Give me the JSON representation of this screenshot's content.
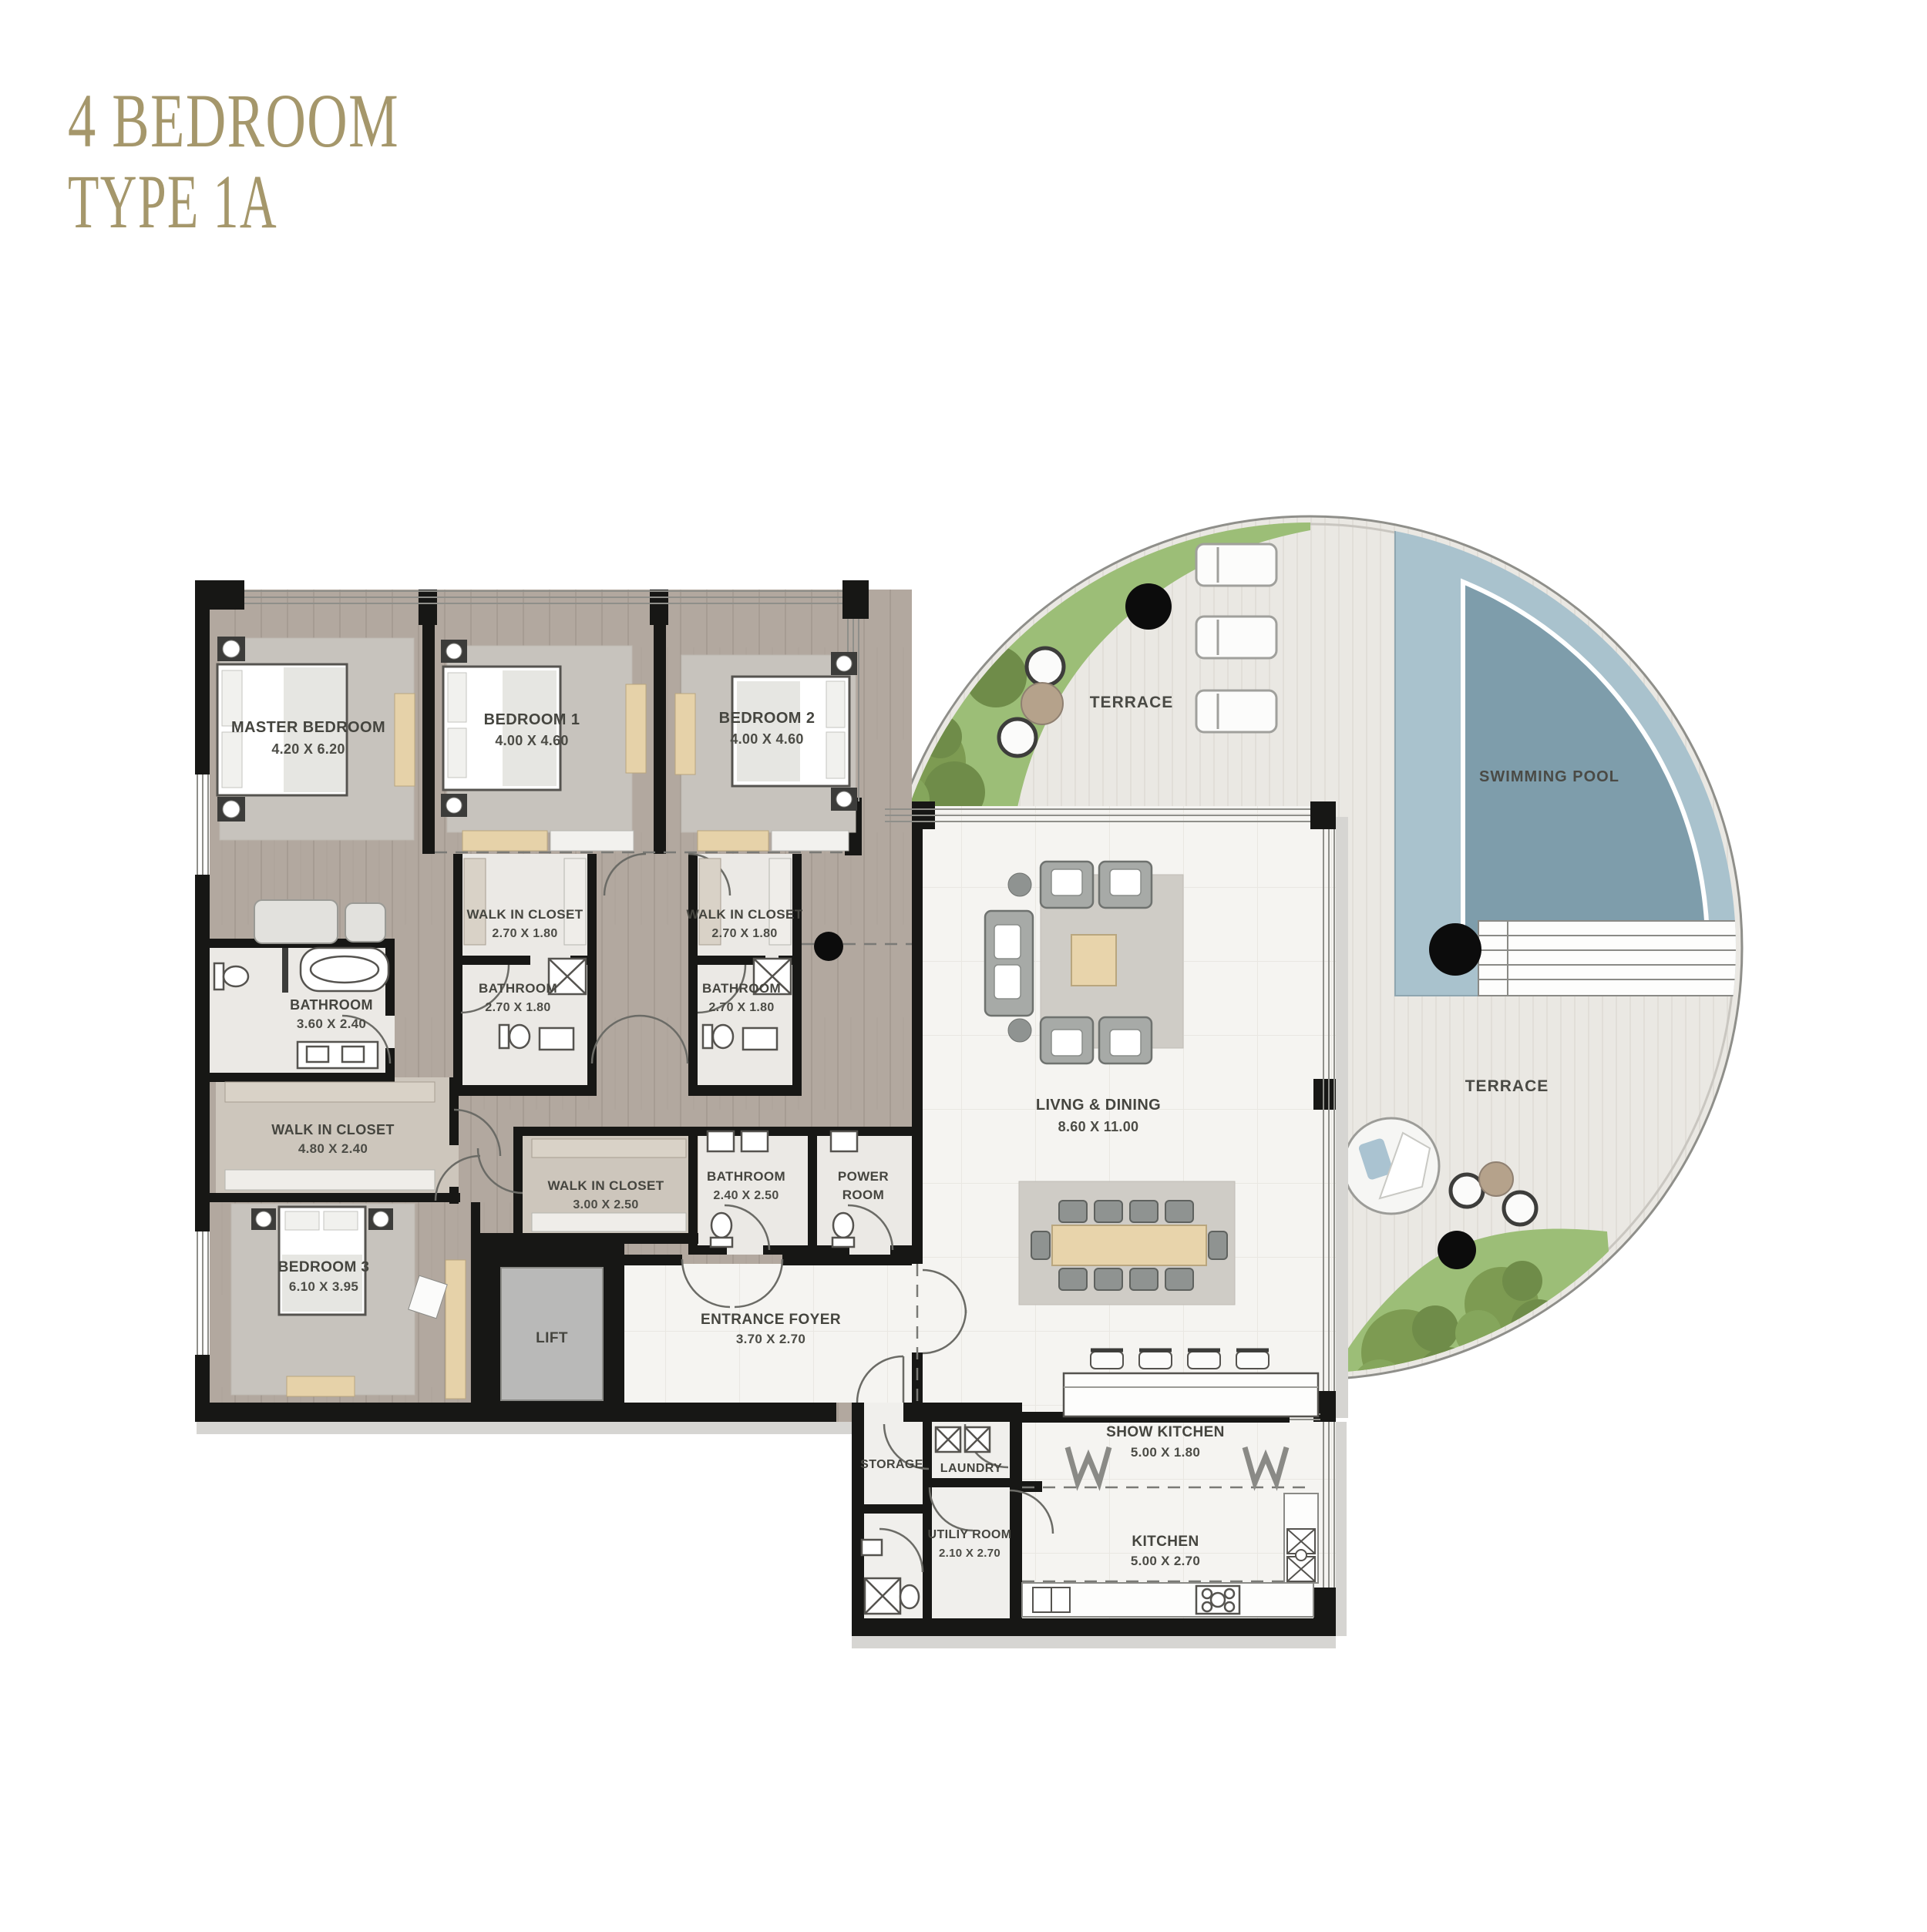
{
  "title": {
    "line1": "4 BEDROOM",
    "line2": "TYPE 1A"
  },
  "colors": {
    "accent_gold": "#a5976b",
    "wall_black": "#171715",
    "pool_outer": "#a9c2cd",
    "pool_inner": "#7e9dab",
    "landscape_green": "#9cbe77",
    "wood_floor": "#b2a89f",
    "marble_floor": "#f5f4f1",
    "terrace_deck": "#eae8e3"
  },
  "rooms": {
    "master_bedroom": {
      "label": "MASTER BEDROOM",
      "dims": "4.20 X 6.20"
    },
    "bedroom1": {
      "label": "BEDROOM 1",
      "dims": "4.00 X 4.60"
    },
    "bedroom2": {
      "label": "BEDROOM 2",
      "dims": "4.00 X 4.60"
    },
    "walk_in_closet1": {
      "label": "WALK IN CLOSET",
      "dims": "2.70 X 1.80"
    },
    "walk_in_closet2": {
      "label": "WALK IN CLOSET",
      "dims": "2.70 X 1.80"
    },
    "bathroom1": {
      "label": "BATHROOM",
      "dims": "2.70 X 1.80"
    },
    "bathroom2": {
      "label": "BATHROOM",
      "dims": "2.70 X 1.80"
    },
    "master_bathroom": {
      "label": "BATHROOM",
      "dims": "3.60 X 2.40"
    },
    "master_closet": {
      "label": "WALK IN CLOSET",
      "dims": "4.80 X 2.40"
    },
    "bedroom3": {
      "label": "BEDROOM 3",
      "dims": "6.10 X 3.95"
    },
    "closet3": {
      "label": "WALK IN CLOSET",
      "dims": "3.00 X 2.50"
    },
    "bathroom3": {
      "label": "BATHROOM",
      "dims": "2.40 X 2.50"
    },
    "power_room": {
      "line1": "POWER",
      "line2": "ROOM"
    },
    "lift": {
      "label": "LIFT"
    },
    "entrance_foyer": {
      "label": "ENTRANCE FOYER",
      "dims": "3.70 X 2.70"
    },
    "living_dining": {
      "label": "LIVNG & DINING",
      "dims": "8.60 X 11.00"
    },
    "storage": {
      "label": "STORAGE"
    },
    "laundry": {
      "label": "LAUNDRY"
    },
    "utility": {
      "label": "UTILIY ROOM",
      "dims": "2.10 X 2.70"
    },
    "show_kitchen": {
      "label": "SHOW KITCHEN",
      "dims": "5.00 X 1.80"
    },
    "kitchen": {
      "label": "KITCHEN",
      "dims": "5.00 X 2.70"
    }
  },
  "outdoor": {
    "terrace": "TERRACE",
    "pool": "SWIMMING POOL"
  }
}
